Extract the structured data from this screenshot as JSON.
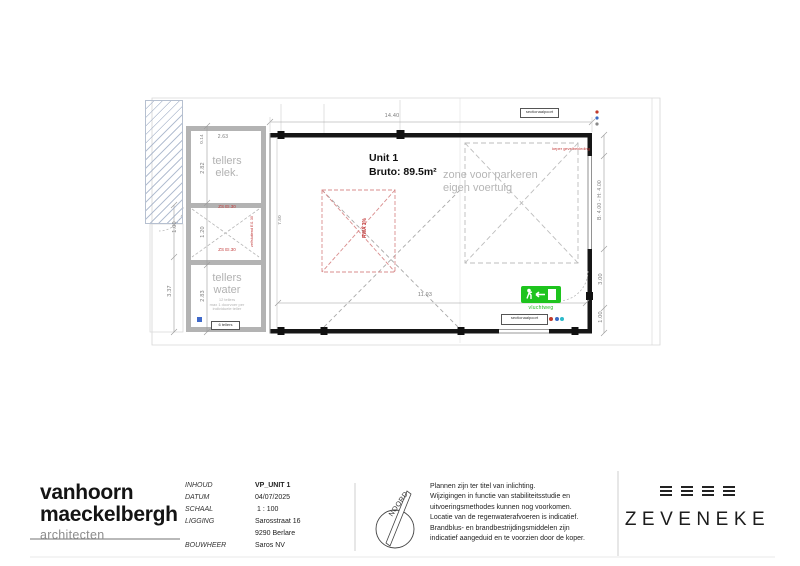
{
  "plan": {
    "unit": {
      "name": "Unit 1",
      "area": "Bruto: 89.5m²"
    },
    "parking_zone": {
      "line1": "zone voor parkeren",
      "line2": "eigen voertuig"
    },
    "rwa": "RWA 3%",
    "exit": {
      "label": "vluchtweg"
    },
    "rooms": {
      "elek1": "tellers",
      "elek2": "elek.",
      "water1": "tellers",
      "water2": "water",
      "water_note1": "12 tellers",
      "water_note2": "max 1 doorvoer per",
      "water_note3": "individuele teller",
      "water_tag": "6 tellers"
    },
    "fire": {
      "zs_top": "ZS EI.30",
      "zs_bottom": "ZS EI.30",
      "side_note": "zelfsluitend EI1 30"
    },
    "notes": {
      "red_top": "keper gevelbekleding",
      "door_top": "sectionaalpoort",
      "door_bottom": "sectionaalpoort"
    },
    "dims": {
      "top": "14.40",
      "bottom": "11.93",
      "interior": "7.50",
      "right_opening": "B: 4.00 - H: 4.00",
      "right_mid": "3.00",
      "right_low": "1.00",
      "l1": "0.14",
      "l2": "2.63",
      "l3": "2.82",
      "l4": "1.20",
      "l5": "2.83",
      "f1": "3.37",
      "f2": "1.00"
    }
  },
  "titleblock": {
    "firm1": "vanhoorn",
    "firm2": "maeckelbergh",
    "firm3": "architecten",
    "f0l": "INHOUD",
    "f0v": "VP_UNIT 1",
    "f1l": "DATUM",
    "f1v": "04/07/2025",
    "f2l": "SCHAAL",
    "f2v": "1 : 100",
    "f3l": "LIGGING",
    "f3v": "Sarosstraat 16",
    "f3v2": "9290 Berlare",
    "f4l": "BOUWHEER",
    "f4v": "Saros NV",
    "north": "NOORD",
    "d0": "Plannen zijn ter titel van inlichting.",
    "d1": "Wijzigingen in functie van stabiliteitsstudie en",
    "d2": "uitvoeringsmethodes kunnen nog voorkomen.",
    "d3": "Locatie van de regenwaterafvoeren is indicatief.",
    "d4": "Brandblus- en brandbestrijdingsmiddelen zijn",
    "d5": "indicatief aangeduid en te voorzien door de koper.",
    "brand": "ZEVENEKE"
  },
  "colors": {
    "accent_green": "#1ec41e",
    "annotation_red": "#c23b3b",
    "dim_gray": "#7c7c7c",
    "wall_black": "#161616"
  }
}
